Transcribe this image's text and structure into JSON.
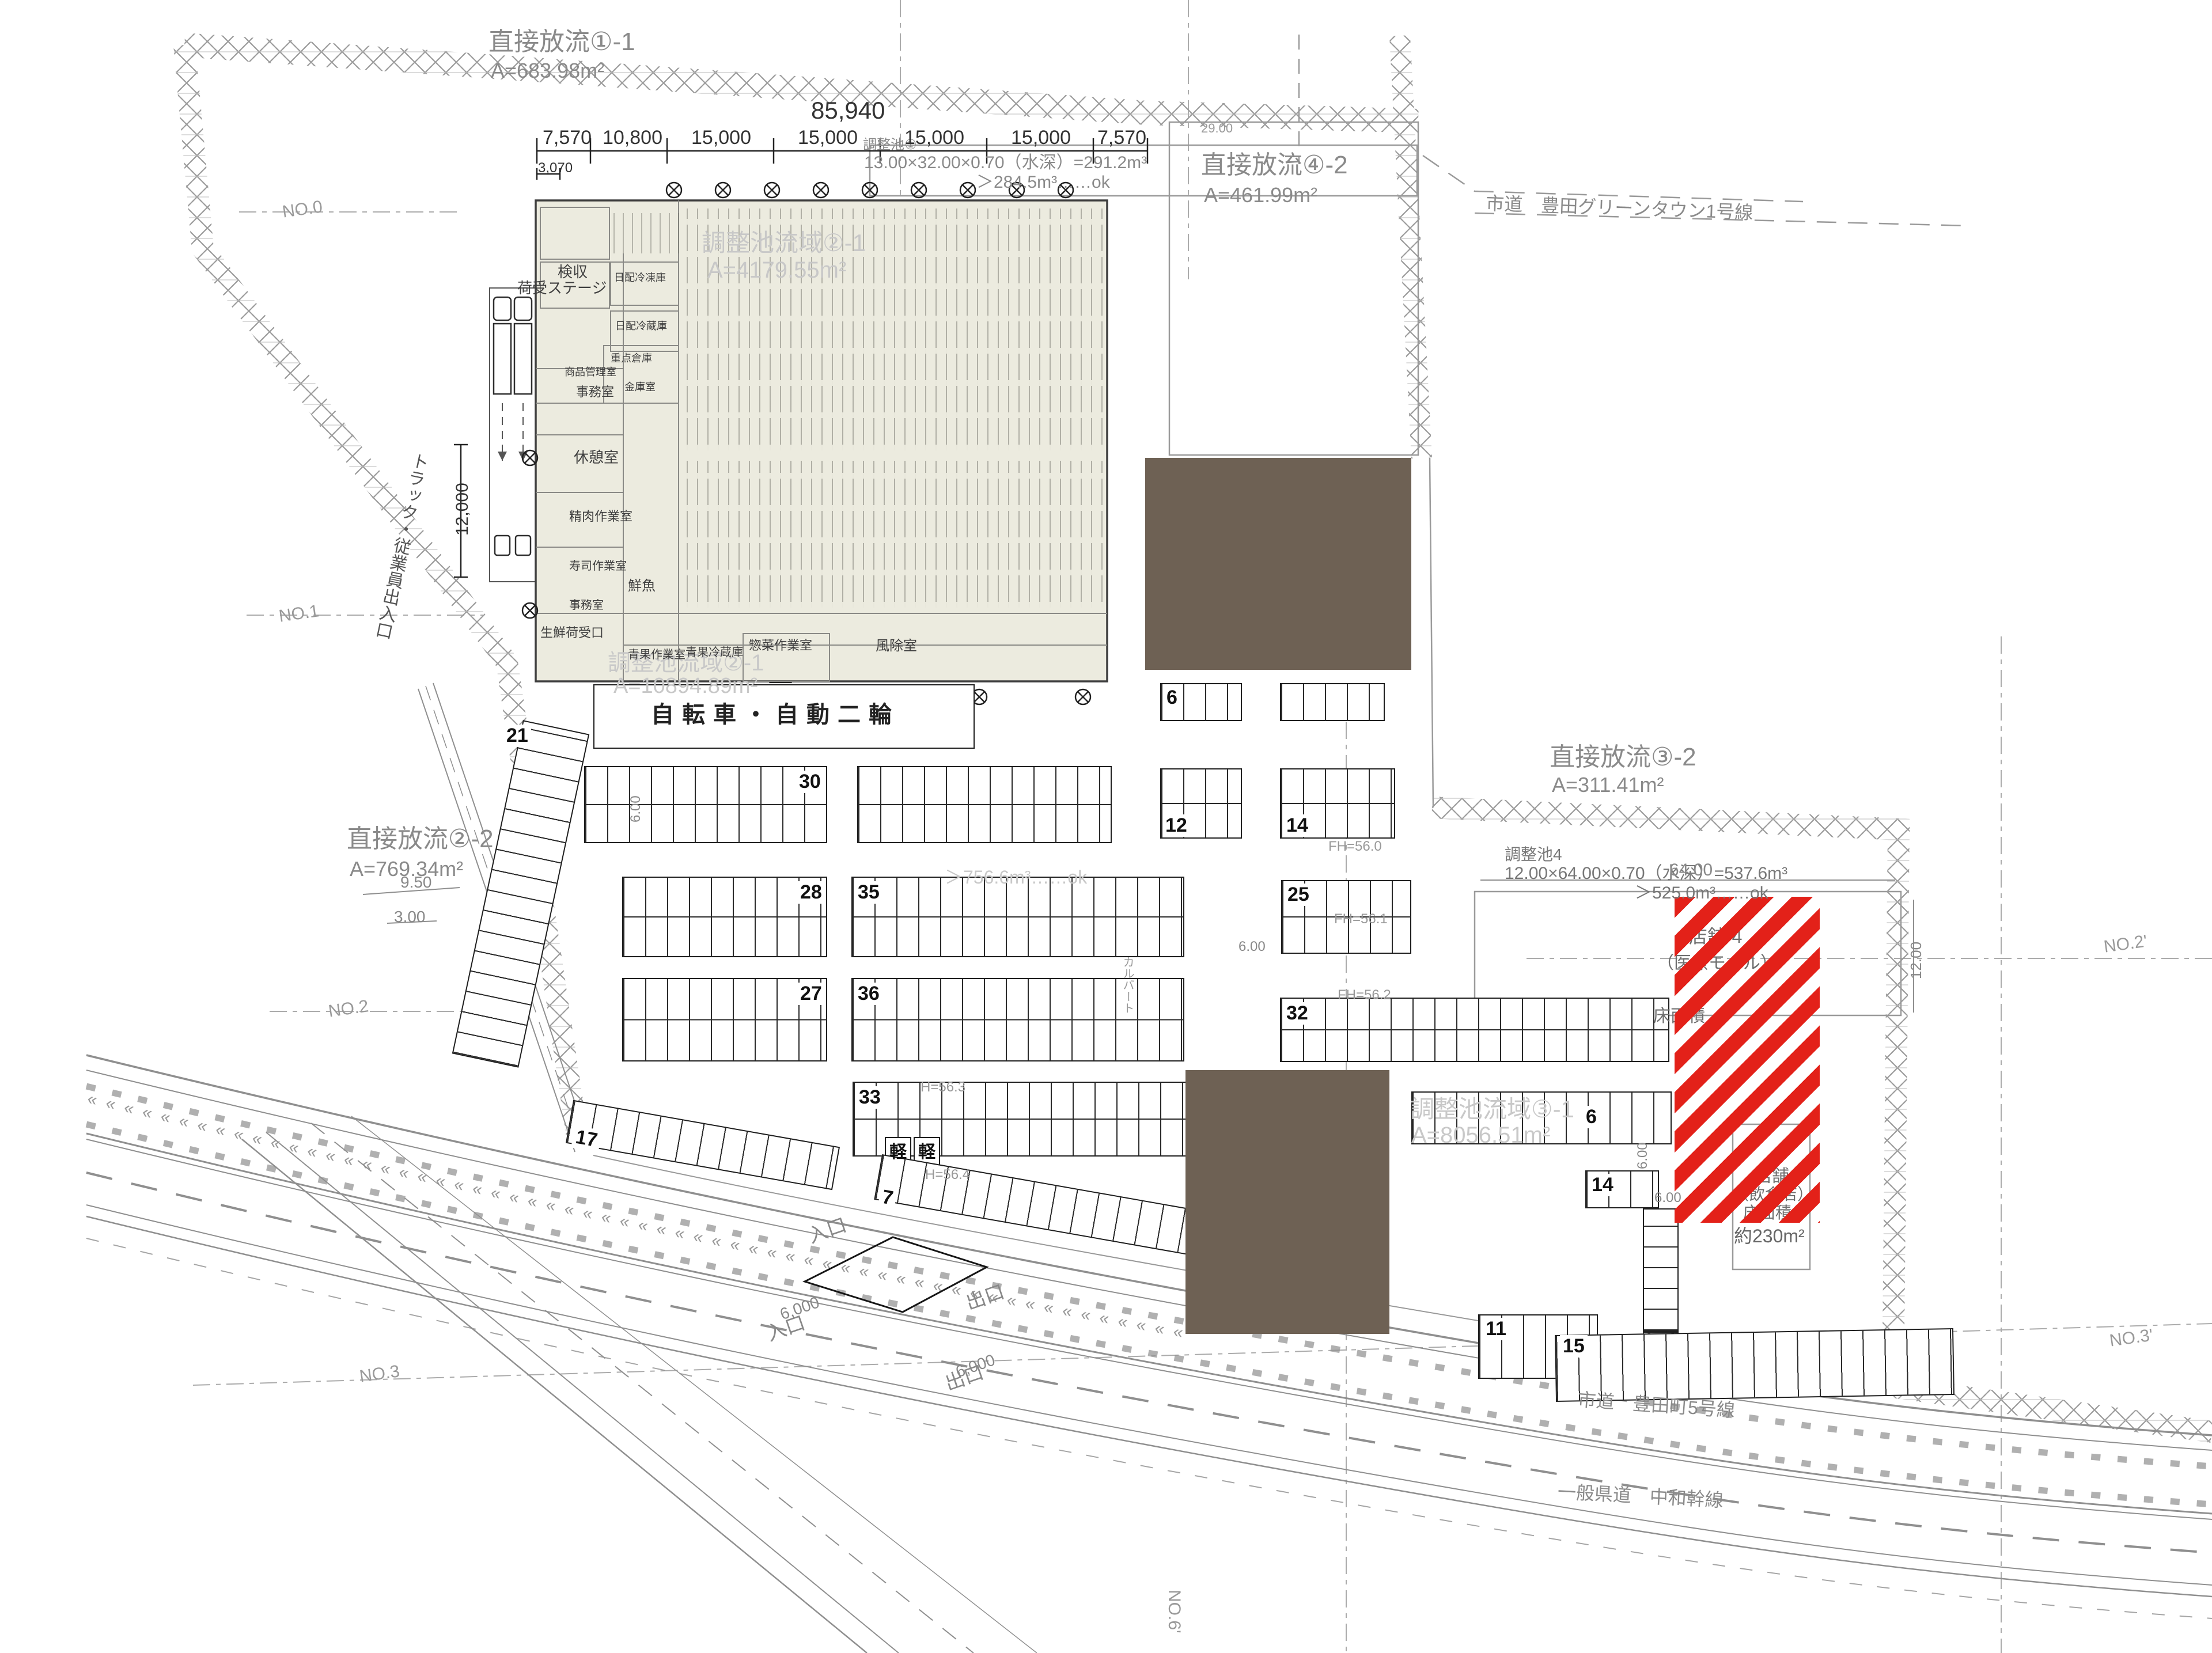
{
  "colors": {
    "accent_red": "#e32119",
    "mass_brown": "#6e6154",
    "building_fill": "#ecebdf",
    "cad_gray": "#8f8f8f",
    "watermark_gray": "#c8c8c8"
  },
  "discharge": {
    "d1": {
      "name": "直接放流①-1",
      "area": "A=683.98m²"
    },
    "d4": {
      "name": "直接放流④-2",
      "area": "A=461.99m²"
    },
    "d2": {
      "name": "直接放流②-2",
      "area": "A=769.34m²"
    },
    "d3": {
      "name": "直接放流③-2",
      "area": "A=311.41m²"
    }
  },
  "ponds": {
    "p1": {
      "name": "調整池①",
      "calc": "13.00×32.00×0.70（水深）=291.2m³",
      "check": "＞284.5m³……ok"
    },
    "p4": {
      "name": "調整池4",
      "calc": "12.00×64.00×0.70（水深）=537.6m³",
      "check": "＞525.0m³……ok"
    }
  },
  "watersheds": {
    "w2a": {
      "name": "調整池流域②-1",
      "area": "A=4179.55m²"
    },
    "w2b": {
      "name": "調整池流域②-1",
      "area": "A=10894.89m²"
    },
    "w3": {
      "name": "調整池流域③-1",
      "area": "A=8056.51m²"
    },
    "check": "＞756.6m³……ok"
  },
  "dims": {
    "total": "85,940",
    "segments": [
      "7,570",
      "10,800",
      "15,000",
      "15,000",
      "15,000",
      "15,000",
      "7,570"
    ],
    "sub": "3,070",
    "left": "12,000",
    "pond4_w": "64.00",
    "pond4_h": "12.00",
    "edge": "29.00",
    "d950": "9.50",
    "d300": "3.00",
    "d600": "6.00",
    "gate": "6,000"
  },
  "roads": {
    "green_town": "市道　豊田グリーンタウン1号線",
    "toyoda5": "市道　豊田町5号線",
    "chuwa": "一般県道　中和幹線"
  },
  "building": {
    "rooms": {
      "stage": "荷受ステージ",
      "kenshu": "検収",
      "jimu1": "事務室",
      "kyukei": "休憩室",
      "seiniku": "精肉作業室",
      "sushi": "寿司作業室",
      "sengyo": "鮮魚",
      "jimu2": "事務室",
      "seisen": "生鮮荷受口",
      "seika_work": "青果作業室",
      "seika_cold": "青果冷蔵庫",
      "sozai": "惣菜作業室",
      "fujo": "風除室",
      "nippai_f": "日配冷凍庫",
      "nippai_c": "日配冷蔵庫",
      "juten": "重点倉庫",
      "kinko": "金庫室",
      "shohin": "商品管理室"
    }
  },
  "parking": {
    "r21": "21",
    "r30": "30",
    "r28": "28",
    "r27": "27",
    "r35": "35",
    "r36": "36",
    "r33": "33",
    "r25": "25",
    "r32": "32",
    "r12": "12",
    "r14a": "14",
    "r6a": "6",
    "r6b": "6",
    "r14b": "14",
    "r11": "11",
    "r15": "15",
    "r17": "17",
    "r7": "7",
    "kei1": "軽",
    "kei2": "軽",
    "bike": "自転車・自動二輪"
  },
  "red_zone": {
    "upper1": "店舗-4",
    "upper2": "（医療モール）",
    "upper3": "床面積",
    "lower1": "店舗",
    "lower2": "（飲食店）",
    "lower3": "床面積",
    "lower4": "約230m²"
  },
  "gates": {
    "in1": "入口",
    "in2": "入口",
    "out1": "出口",
    "out2": "出口"
  },
  "grid": {
    "n0": "NO.0",
    "n1": "NO.1",
    "n2": "NO.2",
    "n3": "NO.3",
    "n2d": "NO.2'",
    "n3d": "NO.3'",
    "n6d": "NO.6'"
  },
  "levels": {
    "fh0": "FH=56.0",
    "fh1": "FH=56.1",
    "fh2": "FH=56.2",
    "h3": "H=56.3",
    "h4": "H=56.4"
  },
  "misc": {
    "truck_entry": "トラック・従業員出入口",
    "culvert": "カルバート"
  }
}
